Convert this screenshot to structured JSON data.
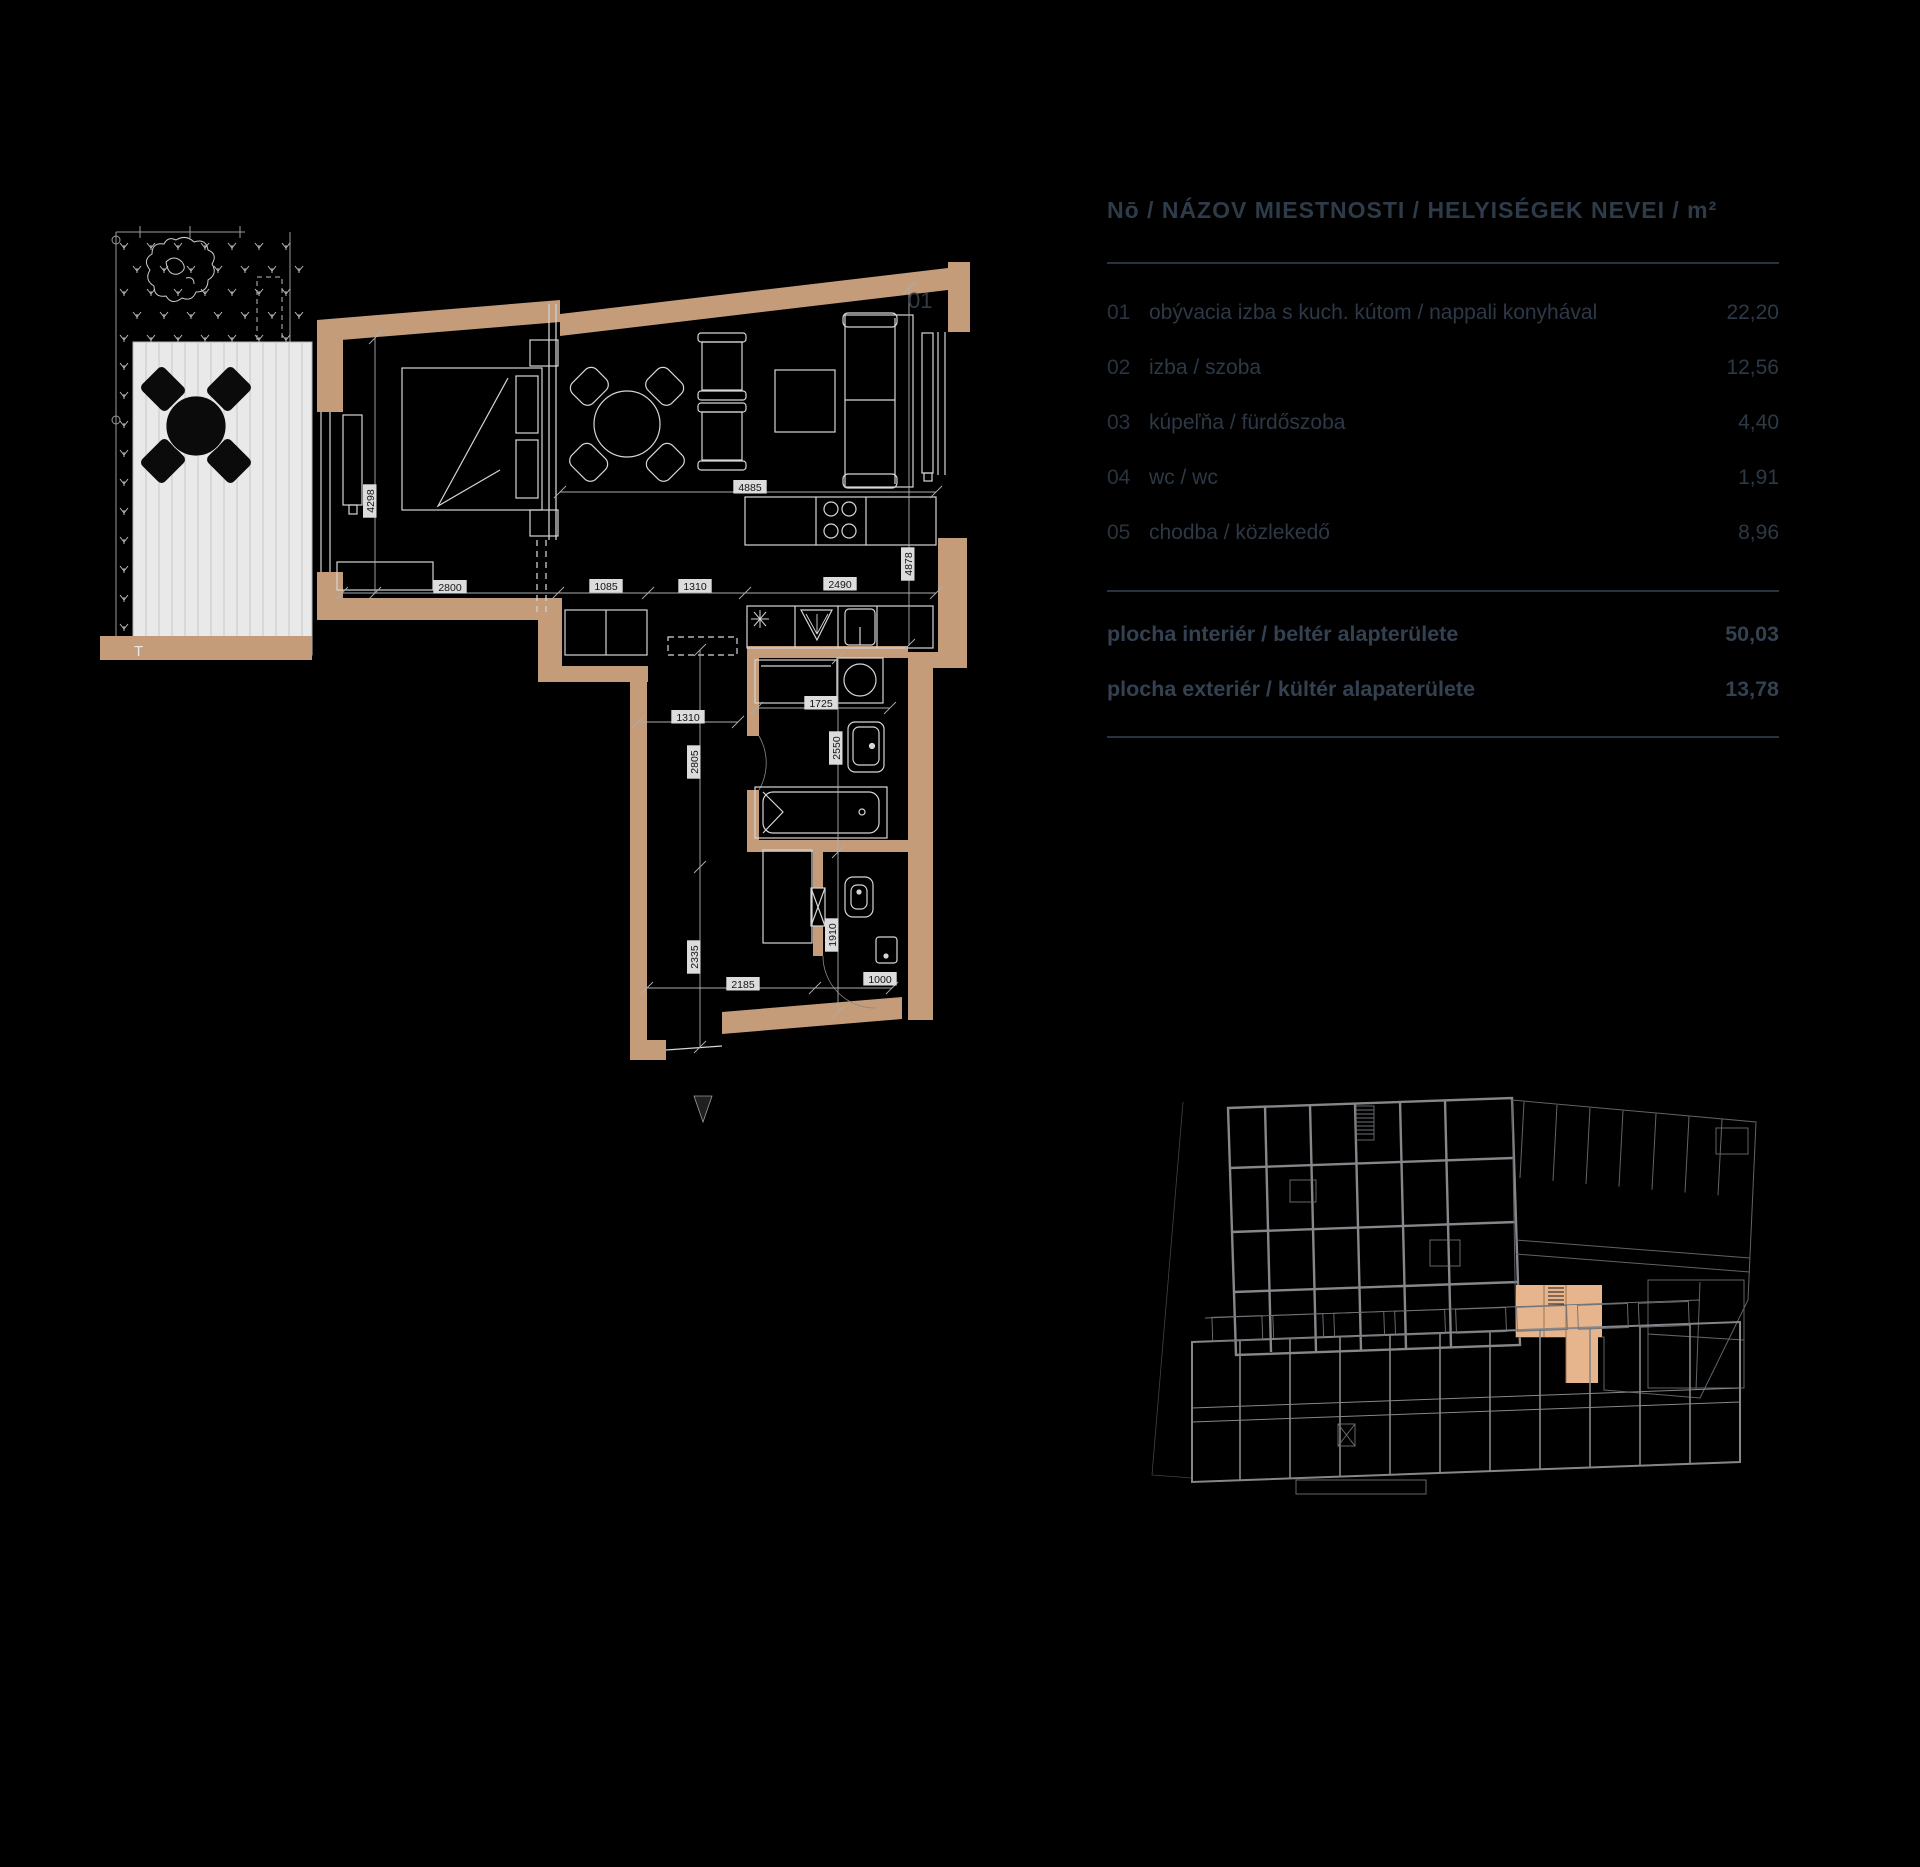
{
  "table": {
    "header": "Nō / NÁZOV MIESTNOSTI / HELYISÉGEK NEVEI / m²",
    "rows": [
      {
        "num": "01",
        "name": "obývacia izba s kuch. kútom / nappali konyhával",
        "area": "22,20"
      },
      {
        "num": "02",
        "name": "izba / szoba",
        "area": "12,56"
      },
      {
        "num": "03",
        "name": "kúpeľňa / fürdőszoba",
        "area": "4,40"
      },
      {
        "num": "04",
        "name": "wc / wc",
        "area": "1,91"
      },
      {
        "num": "05",
        "name": "chodba / közlekedő",
        "area": "8,96"
      }
    ],
    "totals": [
      {
        "label": "plocha interiér / beltér alapterülete",
        "value": "50,03"
      },
      {
        "label": "plocha exteriér / kültér alapaterülete",
        "value": "13,78"
      }
    ]
  },
  "floorplan": {
    "room_label": "01",
    "terrace_label": "T",
    "colors": {
      "wall": "#c49c79",
      "highlight": "#e6b58d",
      "deck": "#e9e9e9",
      "line": "#d6d6d6",
      "dim_line": "#adadad",
      "chip_bg": "#dcdcdc",
      "chip_text": "#141414"
    },
    "dimensions": [
      {
        "text": "2800",
        "x": 450,
        "y": 587,
        "v": false
      },
      {
        "text": "1085",
        "x": 606,
        "y": 586,
        "v": false
      },
      {
        "text": "1310",
        "x": 695,
        "y": 586,
        "v": false
      },
      {
        "text": "2490",
        "x": 840,
        "y": 584,
        "v": false
      },
      {
        "text": "4885",
        "x": 750,
        "y": 487,
        "v": false
      },
      {
        "text": "4298",
        "x": 370,
        "y": 501,
        "v": true
      },
      {
        "text": "4878",
        "x": 908,
        "y": 564,
        "v": true
      },
      {
        "text": "1310",
        "x": 688,
        "y": 717,
        "v": false
      },
      {
        "text": "2805",
        "x": 694,
        "y": 762,
        "v": true
      },
      {
        "text": "2335",
        "x": 694,
        "y": 957,
        "v": true
      },
      {
        "text": "2185",
        "x": 743,
        "y": 984,
        "v": false
      },
      {
        "text": "1000",
        "x": 880,
        "y": 979,
        "v": false
      },
      {
        "text": "1725",
        "x": 821,
        "y": 703,
        "v": false
      },
      {
        "text": "2550",
        "x": 836,
        "y": 748,
        "v": true
      },
      {
        "text": "1910",
        "x": 832,
        "y": 935,
        "v": true
      }
    ]
  }
}
